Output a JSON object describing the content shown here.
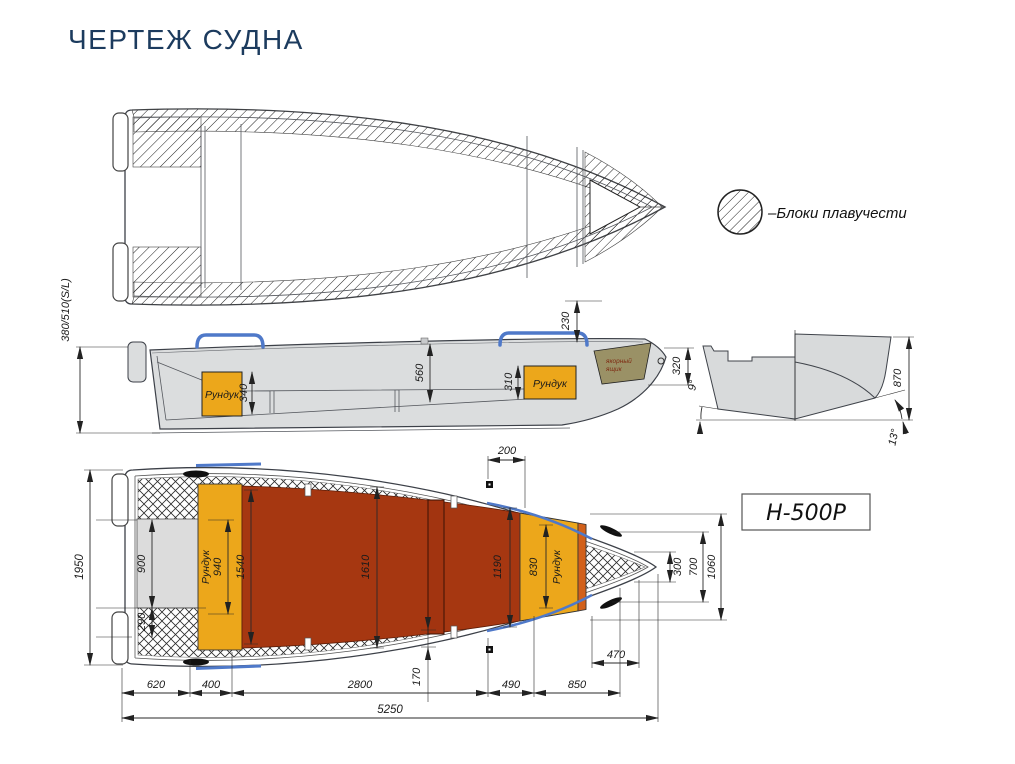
{
  "title": "ЧЕРТЕЖ СУДНА",
  "model_label": "Н-500Р",
  "legend": {
    "label": "–Блоки плавучести"
  },
  "side_view": {
    "transom_height": "380/510(S/L)",
    "bow_deck_drop": "230",
    "bow_sheer_height": "320",
    "cockpit_depth": "560",
    "stern_locker_height": "340",
    "bow_locker_height": "310",
    "stern_locker_label": "Рундук",
    "bow_locker_label": "Рундук",
    "anchor_box_label_line1": "якорный",
    "anchor_box_label_line2": "ящик"
  },
  "section_view": {
    "hull_height": "870",
    "deadrise_aft": "9°",
    "deadrise_fwd": "13°"
  },
  "plan_view": {
    "beam_overall": "1950",
    "motor_well_width": "900",
    "corner_block_width": "290",
    "stern_locker_width": "940",
    "cockpit_width_aft": "1540",
    "cockpit_width_mid": "1610",
    "cockpit_width_fwd": "1190",
    "bow_locker_width": "830",
    "stern_locker_label": "Рундук",
    "bow_locker_label": "Рундук",
    "bow_cleat_offset": "200",
    "bow_width_1": "300",
    "bow_width_2": "700",
    "bow_width_3": "1060",
    "bow_section_length": "470",
    "side_deck_width": "170",
    "len_1": "620",
    "len_2": "400",
    "len_3": "2800",
    "len_4": "490",
    "len_5": "850",
    "length_overall": "5250"
  },
  "colors": {
    "title": "#1C3B5E",
    "hull_gray": "#DBDDDE",
    "locker_orange": "#ECA71B",
    "floor_red": "#A63711",
    "anchor_olive": "#9A9166",
    "rail_blue": "#4F79C9"
  }
}
